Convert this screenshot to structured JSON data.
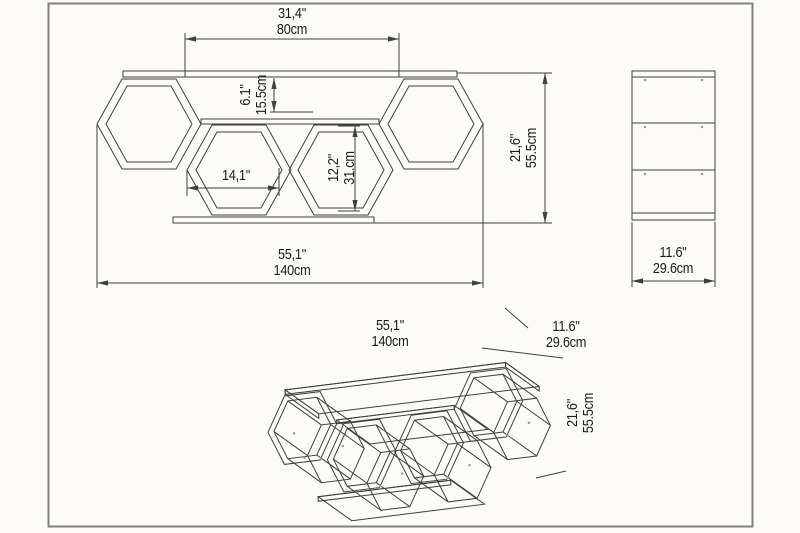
{
  "colors": {
    "background": "#fcfbf8",
    "frame": "#82827e",
    "line": "#3f3f3b",
    "text": "#1b1b19",
    "dot": "#9a9a96"
  },
  "front_view": {
    "top_width": {
      "in": "31,4\"",
      "cm": "80cm"
    },
    "shelf_gap": {
      "in": "6.1\"",
      "cm": "15.5cm"
    },
    "cell_width": {
      "in": "14,1\""
    },
    "cell_height": {
      "in": "12,2\"",
      "cm": "31.cm"
    },
    "height": {
      "in": "21,6\"",
      "cm": "55.5cm"
    },
    "width": {
      "in": "55,1\"",
      "cm": "140cm"
    }
  },
  "side_view": {
    "depth": {
      "in": "11.6\"",
      "cm": "29.6cm"
    }
  },
  "iso_view": {
    "width": {
      "in": "55,1\"",
      "cm": "140cm"
    },
    "depth": {
      "in": "11.6\"",
      "cm": "29.6cm"
    },
    "height": {
      "in": "21,6\"",
      "cm": "55.5cm"
    }
  }
}
